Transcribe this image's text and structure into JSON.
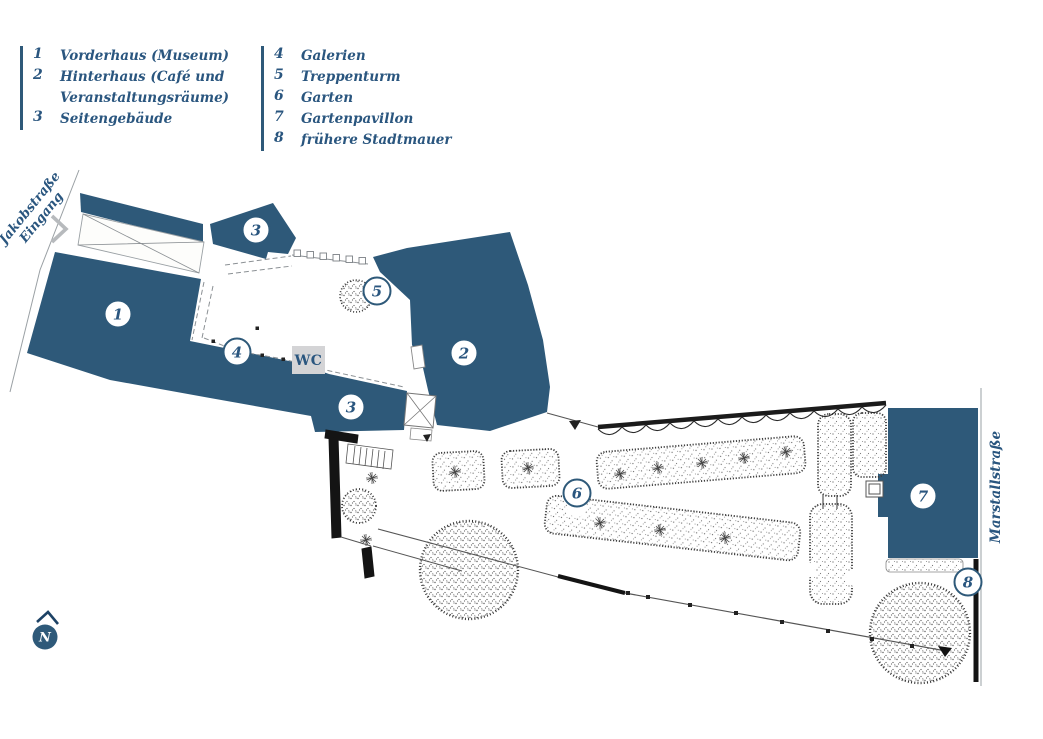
{
  "legend": {
    "column1": [
      {
        "num": "1",
        "label": "Vorderhaus (Museum)"
      },
      {
        "num": "2",
        "label": "Hinterhaus (Café und Veranstaltungsräume)"
      },
      {
        "num": "3",
        "label": "Seitengebäude"
      }
    ],
    "column2": [
      {
        "num": "4",
        "label": "Galerien"
      },
      {
        "num": "5",
        "label": "Treppenturm"
      },
      {
        "num": "6",
        "label": "Garten"
      },
      {
        "num": "7",
        "label": "Gartenpavillon"
      },
      {
        "num": "8",
        "label": "frühere Stadtmauer"
      }
    ]
  },
  "streets": {
    "jakobstrasse": "Jakobstraße",
    "eingang": "Eingang",
    "marstallstrasse": "Marstallstraße"
  },
  "plan": {
    "wc_label": "WC",
    "north_label": "N",
    "markers": [
      {
        "num": "1",
        "x": 118,
        "y": 314
      },
      {
        "num": "2",
        "x": 464,
        "y": 353
      },
      {
        "num": "3",
        "x": 256,
        "y": 230
      },
      {
        "num": "3",
        "x": 351,
        "y": 407
      },
      {
        "num": "4",
        "x": 237,
        "y": 352
      },
      {
        "num": "5",
        "x": 377,
        "y": 291
      },
      {
        "num": "6",
        "x": 577,
        "y": 493
      },
      {
        "num": "7",
        "x": 923,
        "y": 496
      },
      {
        "num": "8",
        "x": 968,
        "y": 582
      }
    ]
  },
  "colors": {
    "building_blue": "#2e5979",
    "text_blue": "#2a567f",
    "wc_background": "#d4d4d6",
    "street_gray": "#9aa0a4",
    "entrance_arrow_gray": "#b7babd"
  }
}
